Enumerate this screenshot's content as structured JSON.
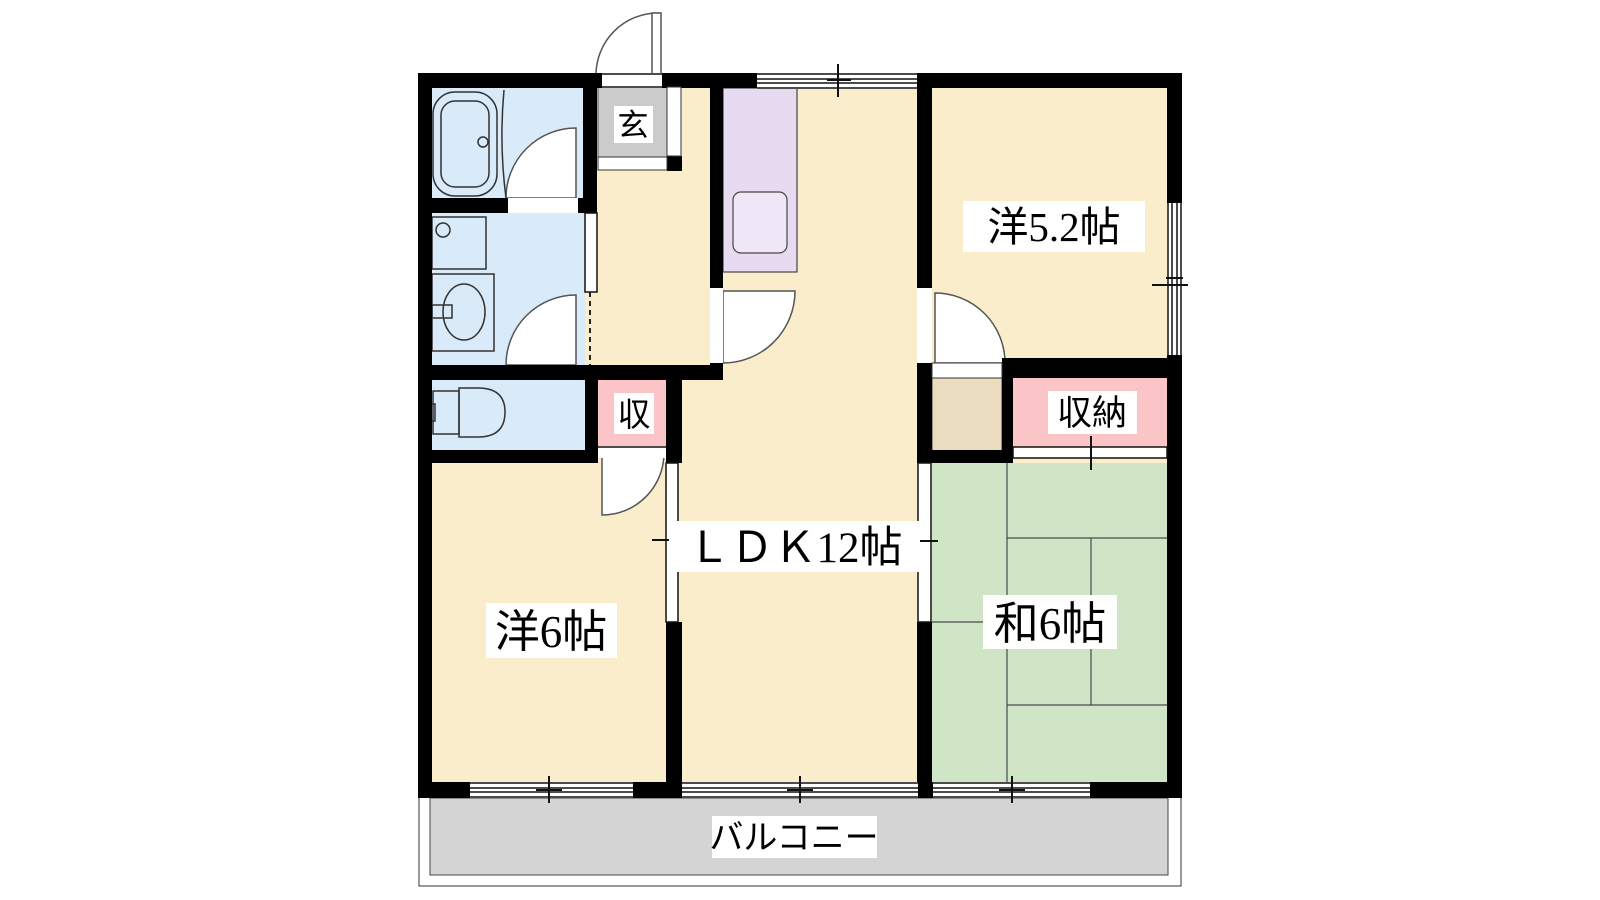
{
  "floorplan": {
    "title": "2LDK apartment floor plan",
    "rooms": {
      "genkan": {
        "label": "玄"
      },
      "western_52": {
        "label": "洋5.2帖"
      },
      "closet": {
        "label": "収"
      },
      "storage": {
        "label": "収納"
      },
      "ldk": {
        "label": "ＬＤＫ12帖"
      },
      "western_6": {
        "label": "洋6帖"
      },
      "japanese_6": {
        "label": "和6帖"
      },
      "balcony": {
        "label": "バルコニー"
      }
    },
    "colors": {
      "floor_cream": "#FAEDCB",
      "wet_blue": "#D9EAF8",
      "kitchen_lavender": "#E7DBF2",
      "sink_lavender": "#EFE7F7",
      "closet_pink": "#FBC5C8",
      "tatami_green": "#CFE5C5",
      "alcove_tan": "#EADCBE",
      "genkan_gray": "#CBCBCB",
      "balcony_gray": "#D4D4D4",
      "wall_black": "#000000"
    }
  }
}
